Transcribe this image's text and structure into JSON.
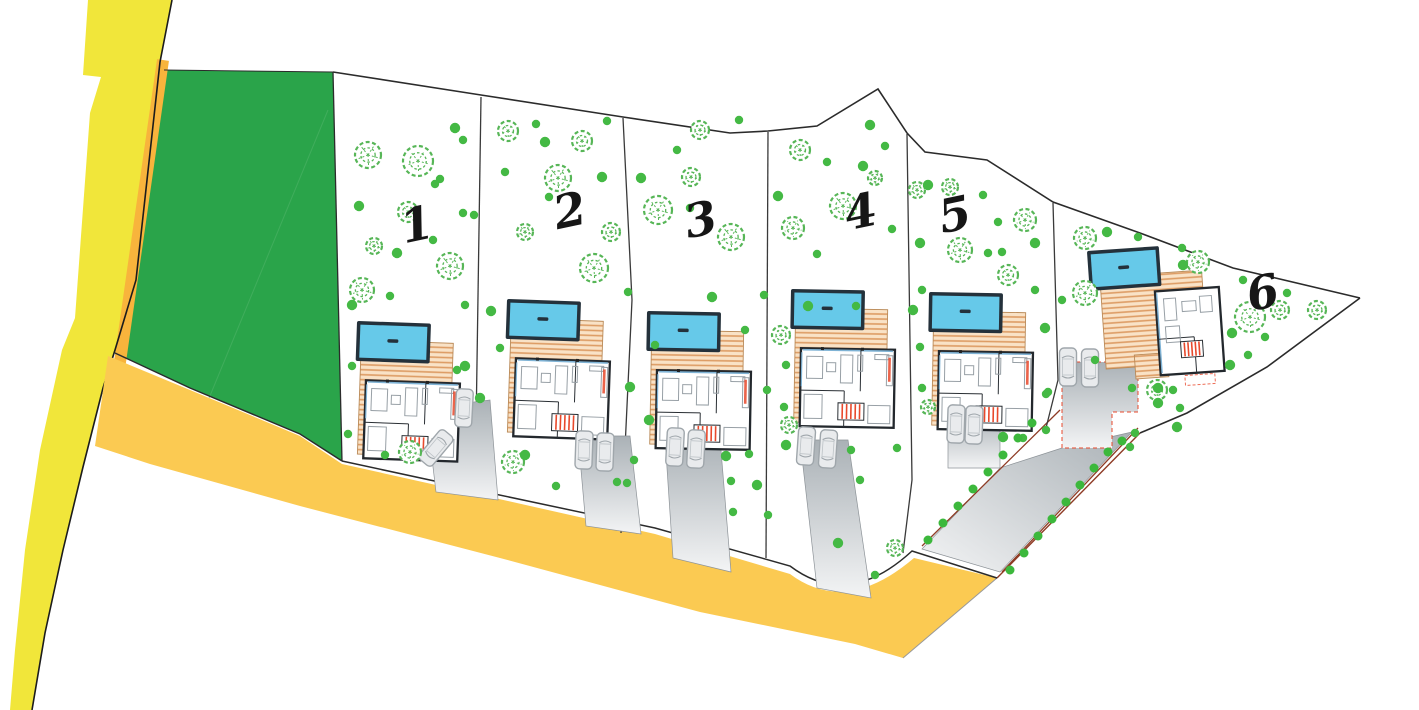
{
  "canvas": {
    "w": 1419,
    "h": 710
  },
  "colors": {
    "bg": "#ffffff",
    "park": "#2aa44a",
    "park_line": "#4fb368",
    "road_vertical": "#f1e63a",
    "road_shoulder": "#f8b43c",
    "road_main": "#fbca52",
    "road_edge": "#1c1c1c",
    "boundary": "#2b2b2b",
    "separator": "#3a3a3a",
    "tree_stroke": "#57b657",
    "dot_fill": "#44b944",
    "bush_fill": "#3cb83c",
    "pool_water": "#66c9e9",
    "pool_frame": "#24313b",
    "deck_bg": "#f9e2c6",
    "deck_line": "#dd9c64",
    "deck_edge": "#b98a58",
    "house_wall": "#23282d",
    "furniture": "#98a0a6",
    "stair_red": "#e8492c",
    "glass": "#7fb3d5",
    "drive_dark": "#aab1b6",
    "drive_light": "#f3f4f5",
    "car_stroke": "#9fa6ab",
    "car_fill": "#e9ebed",
    "red_edge": "#8e3b25",
    "label": "#161616"
  },
  "park": {
    "points": "164,70 333,72 342,461 300,434 190,388 115,353 136,280 159,66",
    "diag_line": [
      200,
      420,
      328,
      110
    ]
  },
  "roads": {
    "vertical_points": "88,0 172,0 160,62 136,280 115,350 103,388 83,467 63,550 45,633 32,710 10,710 15,650 25,550 40,450 62,350 75,318 90,113 101,77 83,75",
    "shoulder_line": [
      163,
      60,
      110,
      432
    ],
    "main_path": "M108,356 L190,390 L300,436 L342,464 L490,497 L655,534 L790,574 Q846,616 914,558 L997,578 L903,658 L855,644 L700,612 L500,558 L300,506 L150,464 L95,446 Z",
    "edge_points": "172,0 160,62 136,280 115,350 103,388 83,467 63,550 45,633 32,710",
    "end_cut": [
      997,
      578,
      903,
      658
    ]
  },
  "boundaries": {
    "top_points": "333,72 481,95 623,117 730,133 768,131 817,126 878,89 907,133 925,152 987,160 1053,202 1140,233 1233,268 1360,298",
    "right_points": "1360,298 1267,367 1187,413 1140,433",
    "right_red": [
      1140,
      433,
      997,
      578
    ],
    "bottom_path": "M342,461 L490,493 L655,528 L790,566 Q848,610 912,551 L997,578",
    "park_bottom_points": "115,353 190,388 300,434 342,461",
    "park_top": [
      164,
      70,
      333,
      72
    ],
    "park_right": [
      333,
      72,
      342,
      461
    ],
    "separators": [
      "481,97 475,495",
      "623,118 632,300 621,533",
      "768,132 766,558",
      "907,134 912,480 903,553",
      "1053,203 1058,380 1045,432"
    ]
  },
  "shared_driveway": {
    "points": "922,549 1000,572 1132,432 1062,448 1000,468",
    "red_lines": [
      [
        922,
        546,
        1060,
        410
      ],
      [
        1002,
        572,
        1138,
        428
      ]
    ],
    "bushes": [
      [
        928,
        540
      ],
      [
        943,
        523
      ],
      [
        958,
        506
      ],
      [
        973,
        489
      ],
      [
        988,
        472
      ],
      [
        1003,
        455
      ],
      [
        1018,
        438
      ],
      [
        1032,
        423
      ],
      [
        1010,
        570
      ],
      [
        1024,
        553
      ],
      [
        1038,
        536
      ],
      [
        1052,
        519
      ],
      [
        1066,
        502
      ],
      [
        1080,
        485
      ],
      [
        1094,
        468
      ],
      [
        1108,
        452
      ],
      [
        1122,
        441
      ]
    ]
  },
  "plots": [
    {
      "id": 1,
      "label": "1",
      "label_x": 420,
      "label_y": 240,
      "villa": {
        "x": 358,
        "y": 322,
        "rot": 2,
        "type": "A"
      },
      "driveway": "426,408 490,400 498,500 436,492",
      "cars": [
        [
          464,
          408,
          3
        ],
        [
          436,
          448,
          40
        ]
      ],
      "big_trees": [
        [
          368,
          155,
          13
        ],
        [
          418,
          161,
          15
        ],
        [
          408,
          212,
          10
        ],
        [
          374,
          246,
          8
        ],
        [
          362,
          290,
          12
        ],
        [
          450,
          266,
          13
        ],
        [
          410,
          452,
          11
        ]
      ],
      "dots": [
        [
          359,
          206
        ],
        [
          435,
          184
        ],
        [
          463,
          140
        ],
        [
          455,
          128
        ],
        [
          440,
          179
        ],
        [
          463,
          213
        ],
        [
          397,
          253
        ],
        [
          474,
          215
        ],
        [
          433,
          240
        ],
        [
          352,
          305
        ],
        [
          465,
          305
        ],
        [
          352,
          366
        ],
        [
          465,
          366
        ],
        [
          348,
          434
        ],
        [
          385,
          455
        ],
        [
          480,
          398
        ],
        [
          390,
          296
        ],
        [
          457,
          370
        ]
      ]
    },
    {
      "id": 2,
      "label": "2",
      "label_x": 573,
      "label_y": 226,
      "villa": {
        "x": 508,
        "y": 300,
        "rot": 2,
        "type": "A"
      },
      "driveway": "578,436 630,436 641,534 586,526",
      "cars": [
        [
          584,
          450,
          2
        ],
        [
          605,
          452,
          2
        ]
      ],
      "big_trees": [
        [
          508,
          131,
          10
        ],
        [
          582,
          141,
          10
        ],
        [
          558,
          178,
          13
        ],
        [
          525,
          232,
          8
        ],
        [
          611,
          232,
          9
        ],
        [
          594,
          268,
          14
        ],
        [
          513,
          462,
          11
        ]
      ],
      "dots": [
        [
          545,
          142
        ],
        [
          607,
          121
        ],
        [
          505,
          172
        ],
        [
          602,
          177
        ],
        [
          549,
          197
        ],
        [
          500,
          348
        ],
        [
          525,
          455
        ],
        [
          556,
          486
        ],
        [
          617,
          482
        ],
        [
          491,
          311
        ],
        [
          536,
          124
        ],
        [
          628,
          292
        ]
      ]
    },
    {
      "id": 3,
      "label": "3",
      "label_x": 704,
      "label_y": 235,
      "villa": {
        "x": 648,
        "y": 312,
        "rot": 1,
        "type": "A"
      },
      "driveway": "665,438 720,438 731,572 673,558",
      "cars": [
        [
          675,
          447,
          3
        ],
        [
          696,
          449,
          3
        ]
      ],
      "big_trees": [
        [
          658,
          210,
          14
        ],
        [
          691,
          177,
          9
        ],
        [
          731,
          237,
          13
        ],
        [
          700,
          130,
          9
        ]
      ],
      "dots": [
        [
          641,
          178
        ],
        [
          677,
          150
        ],
        [
          690,
          208
        ],
        [
          712,
          297
        ],
        [
          739,
          120
        ],
        [
          655,
          345
        ],
        [
          649,
          420
        ],
        [
          733,
          512
        ],
        [
          745,
          330
        ],
        [
          630,
          387
        ],
        [
          634,
          460
        ],
        [
          627,
          483
        ],
        [
          726,
          456
        ],
        [
          749,
          454
        ],
        [
          731,
          481
        ],
        [
          757,
          485
        ],
        [
          764,
          295
        ],
        [
          767,
          390
        ]
      ]
    },
    {
      "id": 4,
      "label": "4",
      "label_x": 864,
      "label_y": 227,
      "villa": {
        "x": 792,
        "y": 290,
        "rot": 1,
        "type": "A"
      },
      "driveway": "800,440 848,440 871,598 817,588",
      "cars": [
        [
          806,
          446,
          4
        ],
        [
          828,
          449,
          4
        ]
      ],
      "big_trees": [
        [
          800,
          150,
          10
        ],
        [
          843,
          206,
          13
        ],
        [
          793,
          228,
          11
        ],
        [
          875,
          178,
          7
        ],
        [
          895,
          548,
          8
        ],
        [
          781,
          335,
          9
        ],
        [
          789,
          425,
          8
        ]
      ],
      "dots": [
        [
          870,
          125
        ],
        [
          885,
          146
        ],
        [
          827,
          162
        ],
        [
          863,
          166
        ],
        [
          817,
          254
        ],
        [
          892,
          229
        ],
        [
          778,
          196
        ],
        [
          786,
          365
        ],
        [
          784,
          407
        ],
        [
          786,
          445
        ],
        [
          851,
          450
        ],
        [
          897,
          448
        ],
        [
          838,
          543
        ],
        [
          875,
          575
        ],
        [
          860,
          480
        ],
        [
          808,
          306
        ],
        [
          856,
          306
        ],
        [
          768,
          515
        ]
      ]
    },
    {
      "id": 5,
      "label": "5",
      "label_x": 958,
      "label_y": 230,
      "villa": {
        "x": 930,
        "y": 293,
        "rot": 1,
        "type": "A"
      },
      "driveway": "948,414 1000,414 1000,468 948,468",
      "cars": [
        [
          956,
          424,
          2
        ],
        [
          974,
          425,
          2
        ]
      ],
      "big_trees": [
        [
          917,
          190,
          8
        ],
        [
          950,
          187,
          8
        ],
        [
          960,
          250,
          12
        ],
        [
          1008,
          275,
          10
        ],
        [
          1025,
          220,
          11
        ],
        [
          928,
          407,
          7
        ]
      ],
      "dots": [
        [
          928,
          185
        ],
        [
          983,
          195
        ],
        [
          998,
          222
        ],
        [
          920,
          243
        ],
        [
          988,
          253
        ],
        [
          922,
          290
        ],
        [
          1035,
          243
        ],
        [
          920,
          347
        ],
        [
          922,
          388
        ],
        [
          1003,
          437
        ],
        [
          1023,
          438
        ],
        [
          1035,
          290
        ],
        [
          1045,
          328
        ],
        [
          1048,
          392
        ],
        [
          1002,
          252
        ],
        [
          913,
          310
        ],
        [
          1046,
          394
        ],
        [
          1046,
          430
        ]
      ]
    },
    {
      "id": 6,
      "label": "6",
      "label_x": 1266,
      "label_y": 308,
      "villa": {
        "x": 1088,
        "y": 252,
        "rot": -4,
        "type": "B"
      },
      "driveway": "1062,362 1138,362 1138,412 1112,412 1112,448 1062,448",
      "driveway_dashed": true,
      "cars": [
        [
          1068,
          367,
          0
        ],
        [
          1090,
          368,
          0
        ]
      ],
      "big_trees": [
        [
          1085,
          238,
          11
        ],
        [
          1085,
          293,
          12
        ],
        [
          1198,
          262,
          11
        ],
        [
          1250,
          317,
          15
        ],
        [
          1280,
          310,
          9
        ],
        [
          1317,
          310,
          9
        ],
        [
          1157,
          390,
          10
        ]
      ],
      "dots": [
        [
          1107,
          232
        ],
        [
          1138,
          237
        ],
        [
          1182,
          248
        ],
        [
          1183,
          265
        ],
        [
          1243,
          280
        ],
        [
          1287,
          293
        ],
        [
          1232,
          333
        ],
        [
          1265,
          337
        ],
        [
          1248,
          355
        ],
        [
          1230,
          365
        ],
        [
          1132,
          388
        ],
        [
          1173,
          390
        ],
        [
          1158,
          403
        ],
        [
          1180,
          408
        ],
        [
          1135,
          433
        ],
        [
          1177,
          427
        ],
        [
          1062,
          300
        ],
        [
          1095,
          360
        ],
        [
          1158,
          388
        ],
        [
          1130,
          447
        ]
      ]
    }
  ]
}
